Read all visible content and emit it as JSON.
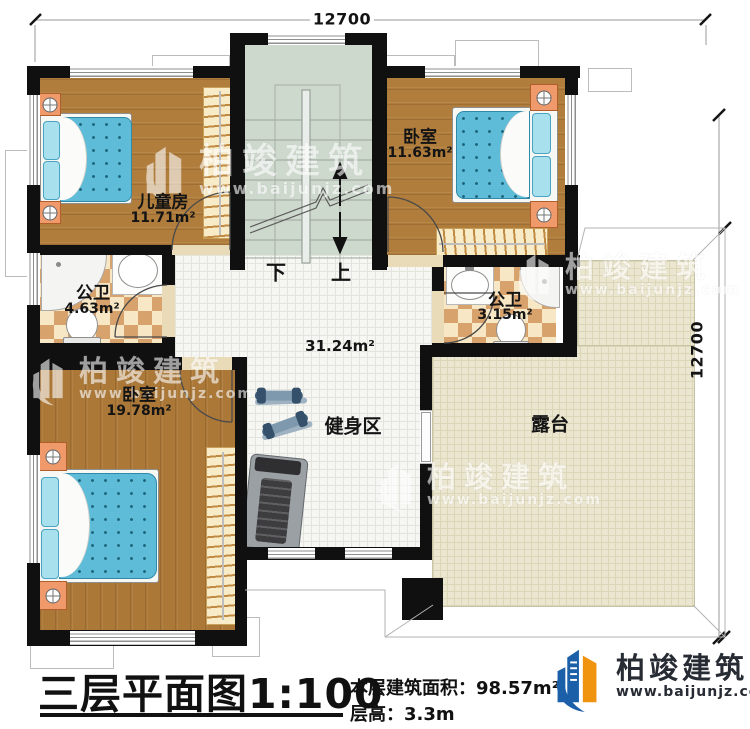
{
  "dimensions": {
    "top": "12700",
    "right": "12700"
  },
  "stairs": {
    "down": "下",
    "up": "上"
  },
  "rooms": {
    "children": {
      "name": "儿童房",
      "area": "11.71m²"
    },
    "bedroom_top": {
      "name": "卧室",
      "area": "11.63m²"
    },
    "bath_left": {
      "name": "公卫",
      "area": "4.63m²"
    },
    "bath_right": {
      "name": "公卫",
      "area": "3.15m²"
    },
    "bedroom_bottom": {
      "name": "卧室",
      "area": "19.78m²"
    },
    "hall": {
      "area": "31.24m²"
    },
    "gym": {
      "name": "健身区"
    },
    "terrace": {
      "name": "露台"
    }
  },
  "titleblock": {
    "title": "三层平面图1:100",
    "area_label": "本层建筑面积：",
    "area_value": "98.57m²",
    "floor_height_label": "层高：",
    "floor_height_value": "3.3m"
  },
  "brand": {
    "name": "柏竣建筑",
    "url": "www.baijunjz.com"
  },
  "watermark": {
    "name": "柏竣建筑",
    "url": "www.baijunjz.com"
  },
  "colors": {
    "wall": "#101010",
    "wood": "#b07d3c",
    "stair": "#ced9cd",
    "checker": "#d7a26b",
    "terrace": "#ebe6d0",
    "bed": "#5fbcd9",
    "logo_blue": "#1b5fa8",
    "logo_orange": "#f0930f"
  }
}
